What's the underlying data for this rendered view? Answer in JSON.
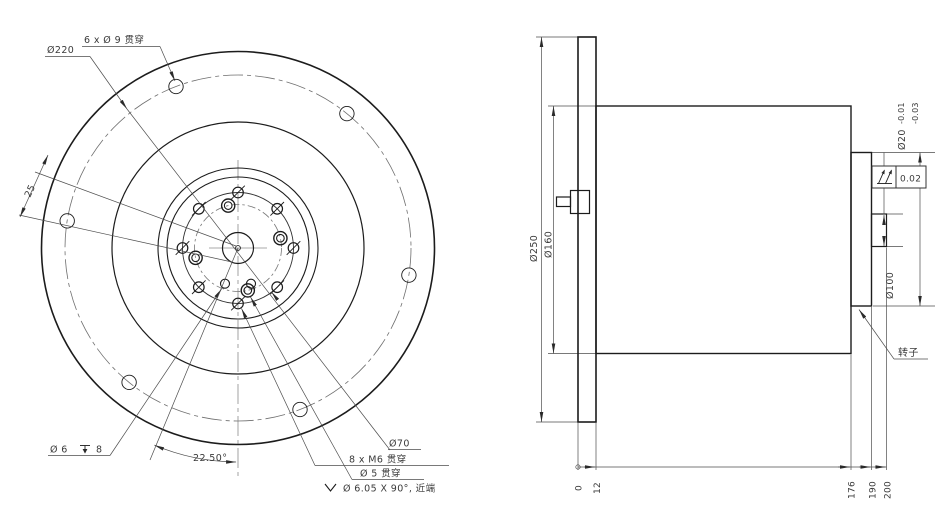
{
  "drawing": {
    "front_view": {
      "note_6x_d9": "6 x Ø 9 贯穿",
      "dim_d220": "Ø220",
      "dim_25": "25",
      "dim_d6_prefix": "Ø 6",
      "dim_d6_depth": "8",
      "dim_angle": "22.50°",
      "dim_d70": "Ø70",
      "note_8x_m6": "8 x M6 贯穿",
      "note_d5": "Ø 5 贯穿",
      "note_csk": "Ø 6.05 X 90°, 近端"
    },
    "side_view": {
      "dim_d250": "Ø250",
      "dim_d160": "Ø160",
      "dim_d100": "Ø100",
      "dim_d20": "Ø20",
      "tol_upper": "-0.01",
      "tol_lower": "-0.03",
      "runout_tolerance": "0.02",
      "label_rotor": "转子",
      "ordinates": [
        "0",
        "12",
        "176",
        "190",
        "200"
      ]
    },
    "colors": {
      "line": "#1c1c1c",
      "dim": "#4d4d4d",
      "center": "#8c8c8c",
      "background": "#ffffff"
    }
  }
}
